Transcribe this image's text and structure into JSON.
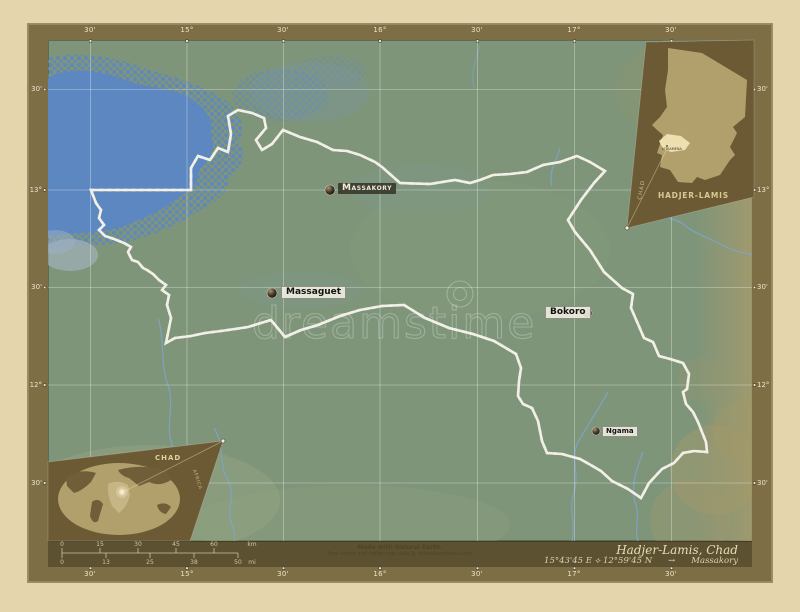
{
  "canvas_color": "#e5d5ad",
  "frame": {
    "band_color": "#7d6e46",
    "footer_color": "#5c5130"
  },
  "map": {
    "land_color": "#7e957a",
    "water_color": "#5d87c0",
    "boundary_color": "#1c1a14",
    "graticule_labels": {
      "top": [
        "30'",
        "15°",
        "30'",
        "16°",
        "30'",
        "17°",
        "30'"
      ],
      "bottom": [
        "30'",
        "15°",
        "30'",
        "16°",
        "30'",
        "17°",
        "30'"
      ],
      "left": [
        "30'",
        "13°",
        "30'",
        "12°",
        "30'"
      ],
      "right": [
        "30'",
        "13°",
        "30'",
        "12°",
        "30'"
      ]
    },
    "cities": [
      {
        "name": "Massakory"
      },
      {
        "name": "Massaguet"
      },
      {
        "name": "Bokoro"
      },
      {
        "name": "Ngama"
      }
    ],
    "watermark": "dreamstime"
  },
  "insets": {
    "region": {
      "country": "CHAD",
      "region": "HADJER-LAMIS",
      "capital": "N'DJAMENA"
    },
    "world": {
      "country": "CHAD",
      "edge_label": "AFRICA"
    }
  },
  "footer": {
    "scalebar": {
      "km": [
        "0",
        "15",
        "30",
        "45",
        "60"
      ],
      "km_unit": "km",
      "mi": [
        "0",
        "13",
        "25",
        "38",
        "50"
      ],
      "mi_unit": "mi"
    },
    "attribution1": "Made with Natural Earth.",
    "attribution2": "Free vector and raster map data @ naturalearthdata.com",
    "title": "Hadjer-Lamis, Chad",
    "coords": "15°43'45 E ⟡ 12°59'45 N",
    "arrow": "→",
    "place": "Massakory"
  }
}
